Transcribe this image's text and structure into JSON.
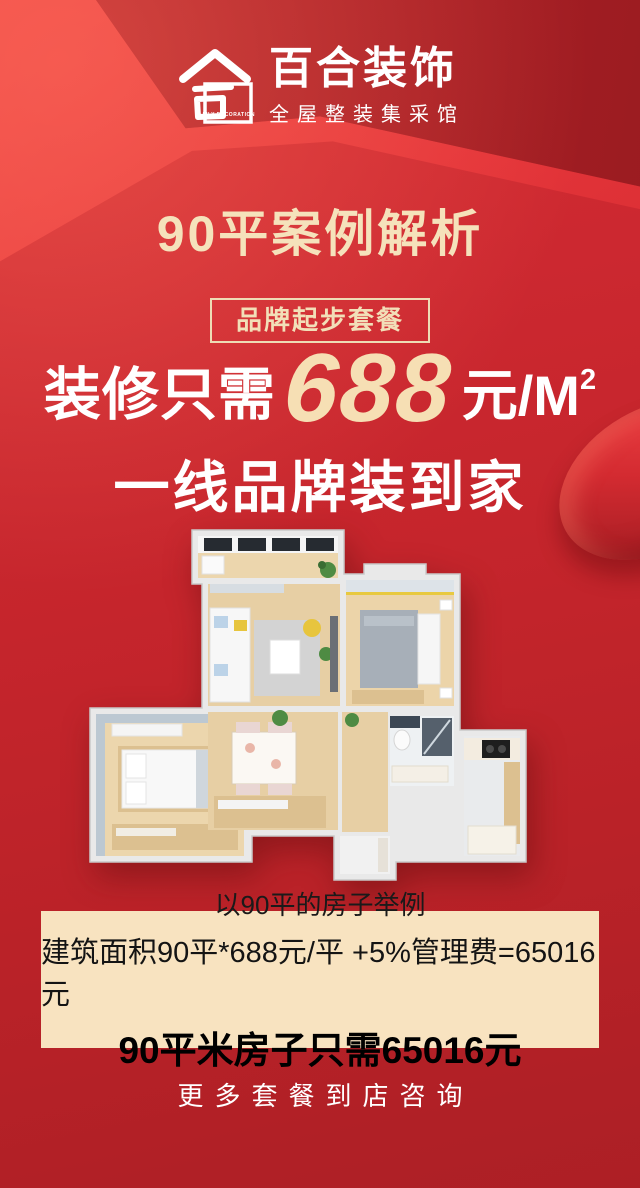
{
  "brand": {
    "name": "百合装饰",
    "tagline": "全屋整装集采馆",
    "logo_glyph": "合",
    "stamp_text": "LILY DECORATION"
  },
  "headline": {
    "title": "90平案例解析",
    "badge": "品牌起步套餐"
  },
  "offer": {
    "prefix": "装修只需",
    "price": "688",
    "unit": "元/M",
    "unit_sup": "2",
    "slogan": "一线品牌装到家"
  },
  "floorplan": {
    "description": "90平两居室3D户型俯视效果图",
    "rooms": [
      "阳台",
      "客厅",
      "主卧",
      "次卧",
      "餐厅",
      "卫生间",
      "厨房",
      "玄关"
    ]
  },
  "calc_box": {
    "line1": "以90平的房子举例",
    "line2": "建筑面积90平*688元/平 +5%管理费=65016元",
    "line3": "90平米房子只需65016元"
  },
  "footer": {
    "cta": "更多套餐到店咨询"
  },
  "colors": {
    "base_red": "#ca262d",
    "dark_red": "#9e1c22",
    "bright_red": "#ea3f3f",
    "bottom_red": "#b22127",
    "cream": "#f5e2bb",
    "box_bg": "#f8e3c0",
    "white": "#ffffff"
  }
}
